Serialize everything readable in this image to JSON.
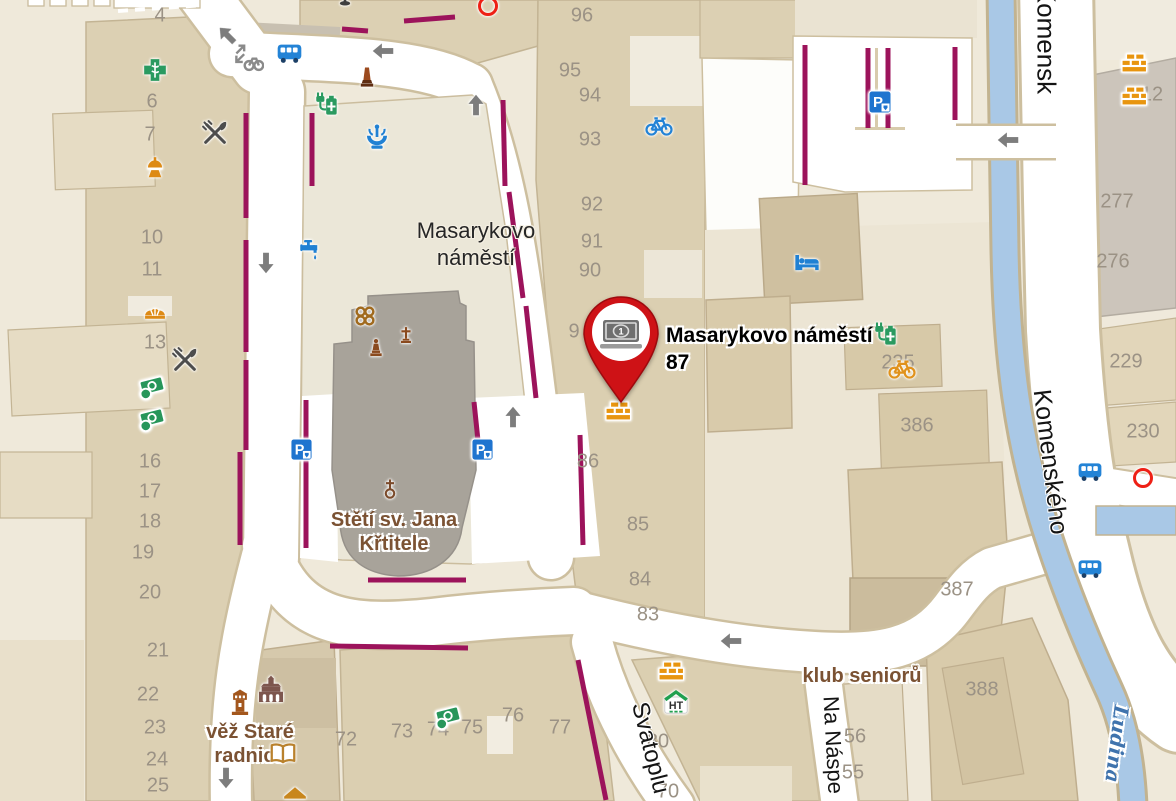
{
  "marker": {
    "pin_value": "1",
    "label_line1": "Masarykovo náměstí",
    "label_line2": "87"
  },
  "area_label": {
    "line1": "Masarykovo",
    "line2": "náměstí"
  },
  "poi_labels": {
    "church_line1": "Stětí sv. Jana",
    "church_line2": "Křtitele",
    "townhall_line1": "věž Staré",
    "townhall_line2": "radnice",
    "seniors_club": "klub seniorů"
  },
  "street_labels": {
    "komensky_top": "Komensk",
    "komenskeho": "Komenského",
    "svatoplukova": "Svatoplu",
    "na_naspech": "Na Náspe"
  },
  "river_label": "Ludina",
  "house_numbers": [
    "4",
    "6",
    "7",
    "10",
    "11",
    "13",
    "16",
    "17",
    "18",
    "19",
    "20",
    "21",
    "22",
    "23",
    "24",
    "25",
    "96",
    "95",
    "94",
    "93",
    "92",
    "91",
    "90",
    "9",
    "86",
    "85",
    "84",
    "83",
    "72",
    "73",
    "74",
    "75",
    "76",
    "77",
    "80",
    "70",
    "277",
    "276",
    "229",
    "230",
    "386",
    "387",
    "388",
    "56",
    "55",
    "235",
    "12"
  ],
  "colors": {
    "pin_red": "#ce1216",
    "restricted_line_magenta": "#9c135b",
    "water_blue": "#a9c8e6",
    "building_tan": "#dccfb2",
    "street_white": "#ffffff",
    "poi_label_brown": "#7b5233",
    "house_number_gray": "#9b9285",
    "river_label_blue": "#3f73ad"
  },
  "icon_legend": {
    "pharmacy-icon": "green cross",
    "restaurant-icon": "crossed fork and knife",
    "bus-stop-icon": "blue bus",
    "parking-icon": "blue P sign",
    "money-exchange-icon": "green banknote with coin",
    "construction-icon": "orange bricks",
    "bicycle-icon": "bicycle",
    "hotel-icon": "blue bed",
    "ev-charging-icon": "green battery with plug",
    "fountain-icon": "blue fountain",
    "drinking-water-icon": "blue tap",
    "library-icon": "open book",
    "tower-icon": "brown town-hall tower",
    "town-hall-icon": "brown historic building",
    "church-icon": "cross over circle",
    "monument-icon": "brown obelisk",
    "sculpture-icon": "brown knot ornament",
    "statue-icon": "statue on pedestal",
    "cross-icon": "brown wayside cross",
    "lamp-icon": "orange lantern",
    "bakery-icon": "orange pastry",
    "ht-house-icon": "house with green roof and HT letters",
    "transit-stop-icon": "red circle outline",
    "direction-arrow-icon": "gray one-way arrow",
    "cycle-route-icon": "gray bicycle with small arrows",
    "map-pin": "red pin with banknote symbol"
  }
}
